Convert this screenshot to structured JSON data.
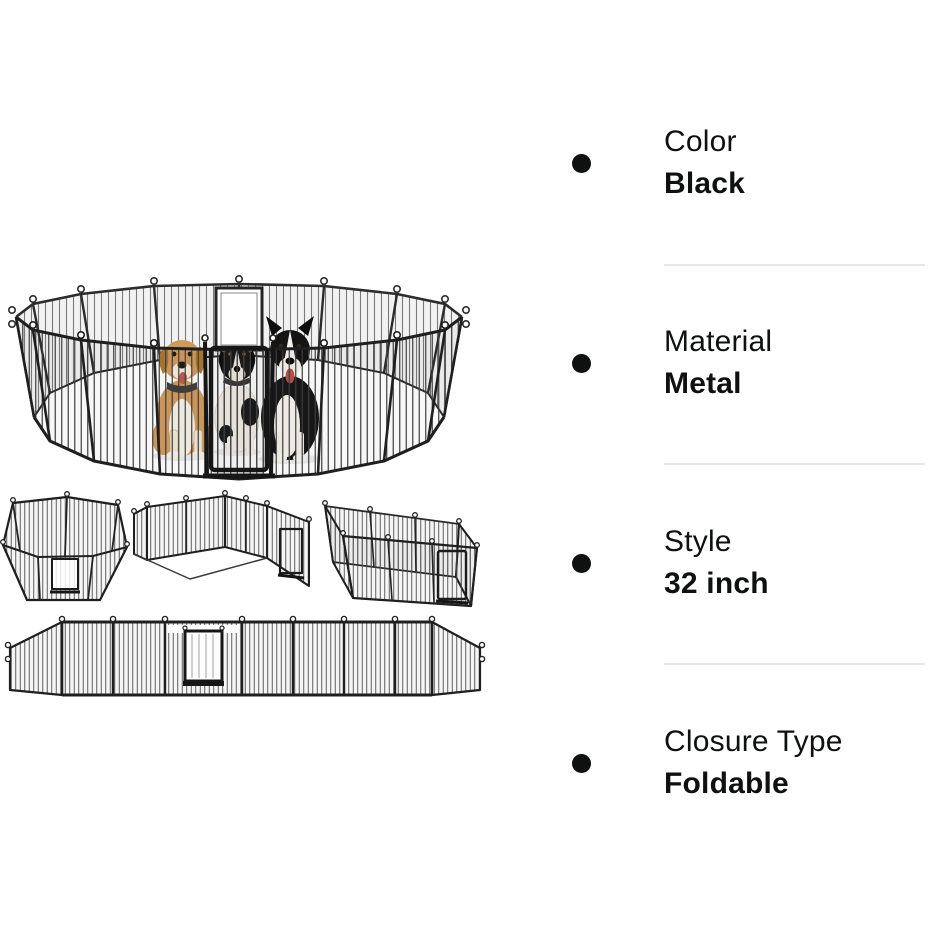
{
  "page": {
    "background": "#ffffff",
    "kind": "product-attribute-overview"
  },
  "specs": {
    "items": [
      {
        "label": "Color",
        "value": "Black"
      },
      {
        "label": "Material",
        "value": "Metal"
      },
      {
        "label": "Style",
        "value": "32 inch"
      },
      {
        "label": "Closure Type",
        "value": "Foldable"
      }
    ],
    "text_color": "#0f1111",
    "bullet_color": "#0f1111",
    "divider_color": "#e7e7e7"
  },
  "images": {
    "main_label": "metal dog playpen circle with three dogs",
    "config_labels": [
      "hexagon-pen",
      "l-shape-pen",
      "rectangle-pen"
    ],
    "flat_label": "panels-unfolded-flat",
    "fence_color": "#1f1f1f",
    "mesh_color": "#3d3d3d",
    "dog_colors": {
      "tan": "#d09a5d",
      "black_fur": "#181818",
      "white_fur": "#f6f1e6",
      "tongue": "#bf4f47"
    }
  }
}
